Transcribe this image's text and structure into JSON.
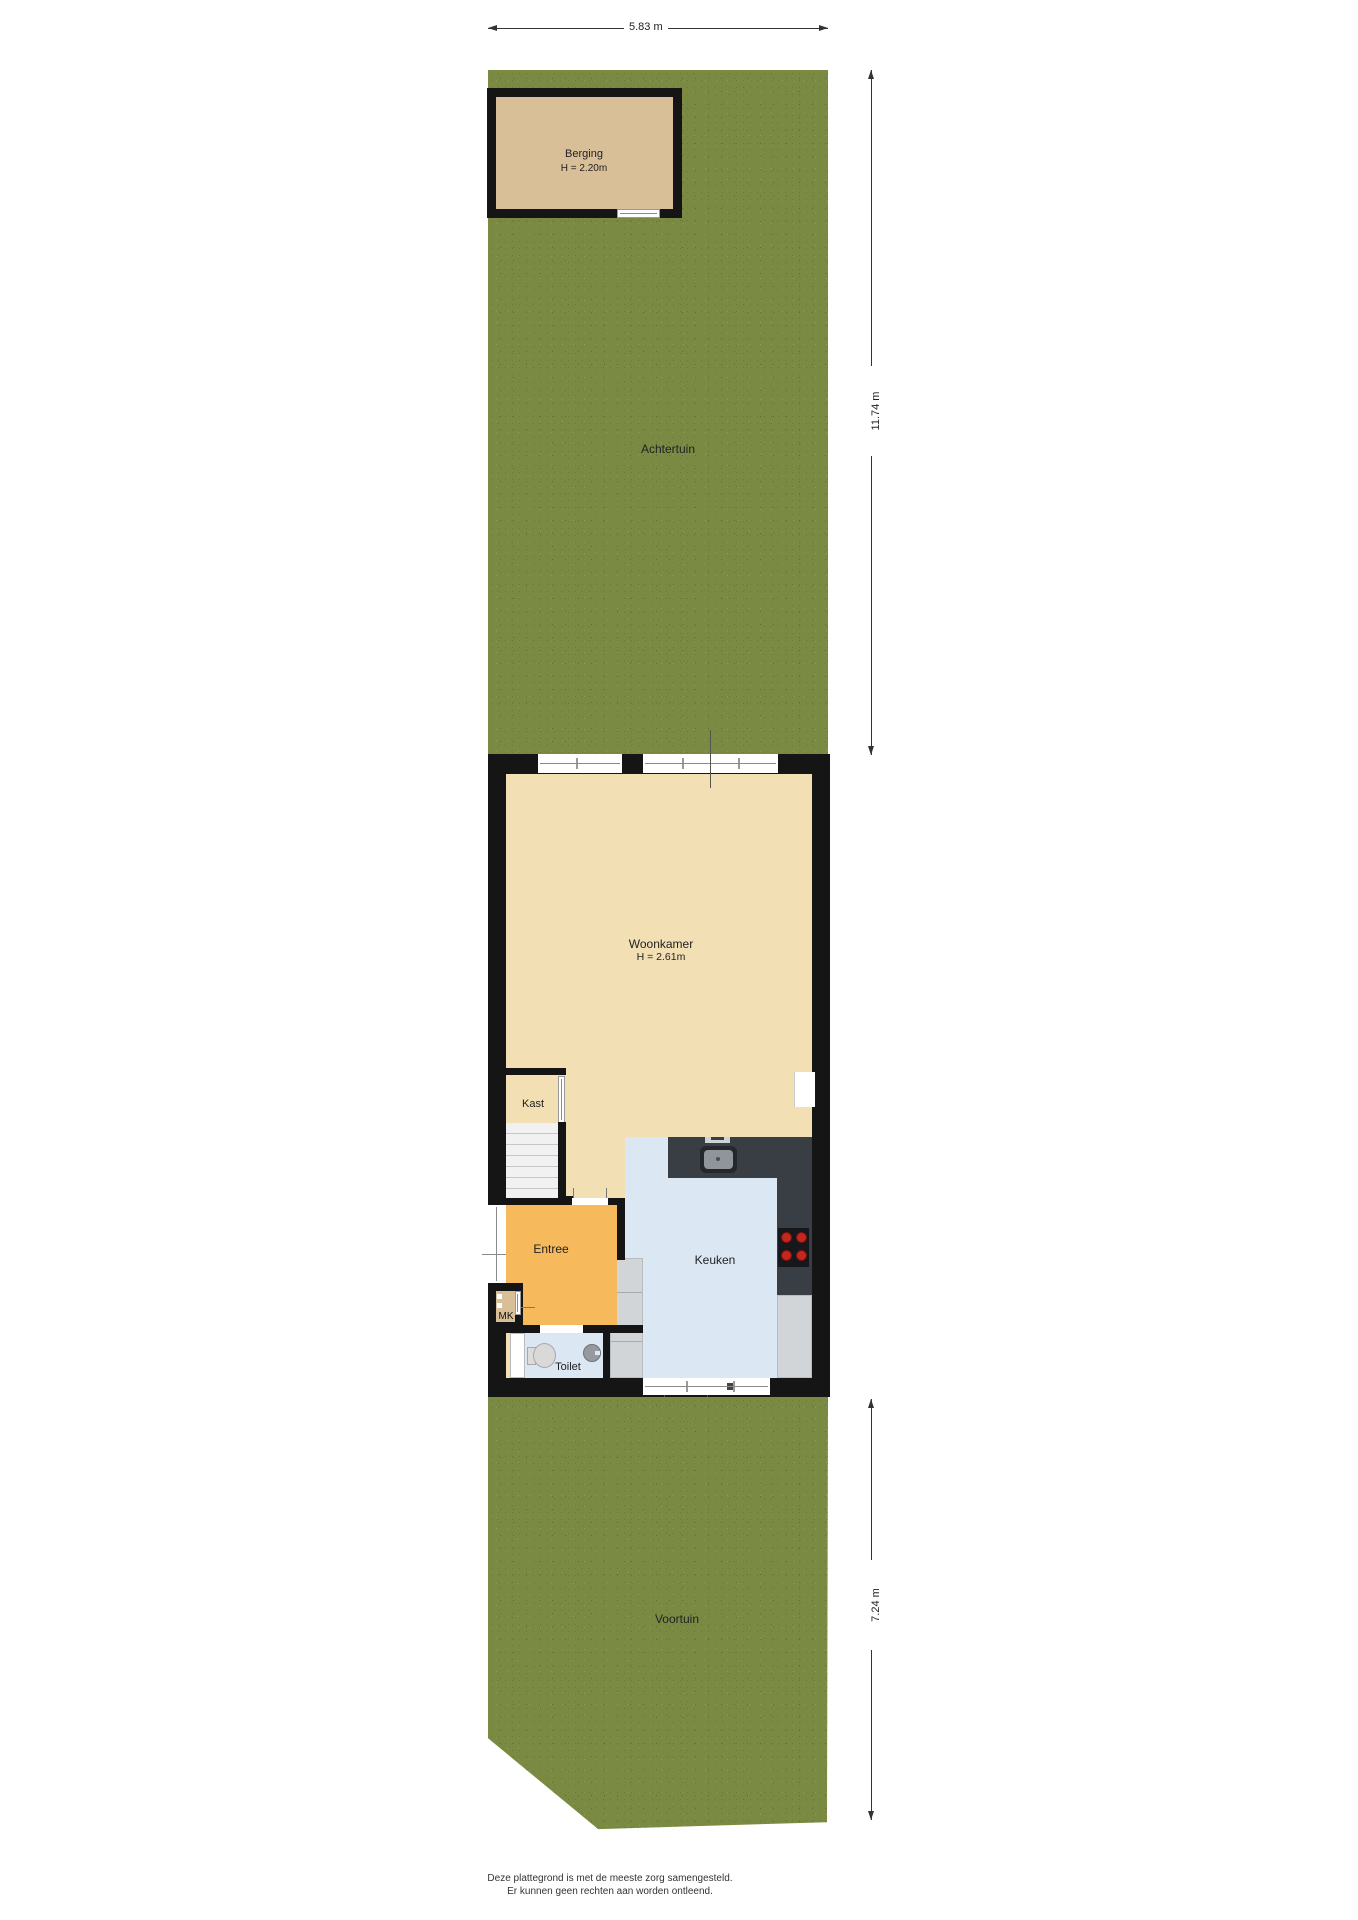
{
  "rooms": {
    "berging": {
      "name": "Berging",
      "height": "H = 2.20m"
    },
    "achtertuin": {
      "name": "Achtertuin"
    },
    "woonkamer": {
      "name": "Woonkamer",
      "height": "H = 2.61m"
    },
    "kast": {
      "name": "Kast"
    },
    "entree": {
      "name": "Entree"
    },
    "keuken": {
      "name": "Keuken"
    },
    "toilet": {
      "name": "Toilet"
    },
    "mk": {
      "name": "MK"
    },
    "voortuin": {
      "name": "Voortuin"
    }
  },
  "dimensions": {
    "plot_width": "5.83 m",
    "back_garden_depth": "11.74 m",
    "front_garden_depth": "7.24 m"
  },
  "footer": {
    "line1": "Deze plattegrond is met de meeste zorg samengesteld.",
    "line2": "Er kunnen geen rechten aan worden ontleend."
  },
  "colors": {
    "grass": "#7b8a43",
    "wall": "#151515",
    "floor_living": "#f2dfb4",
    "floor_berging": "#d9bf98",
    "floor_entree": "#f6b95c",
    "floor_kitchen": "#dbe7f3",
    "counter": "#393d44",
    "cabinet": "#d2d5d8",
    "burner_red": "#c4271f"
  }
}
